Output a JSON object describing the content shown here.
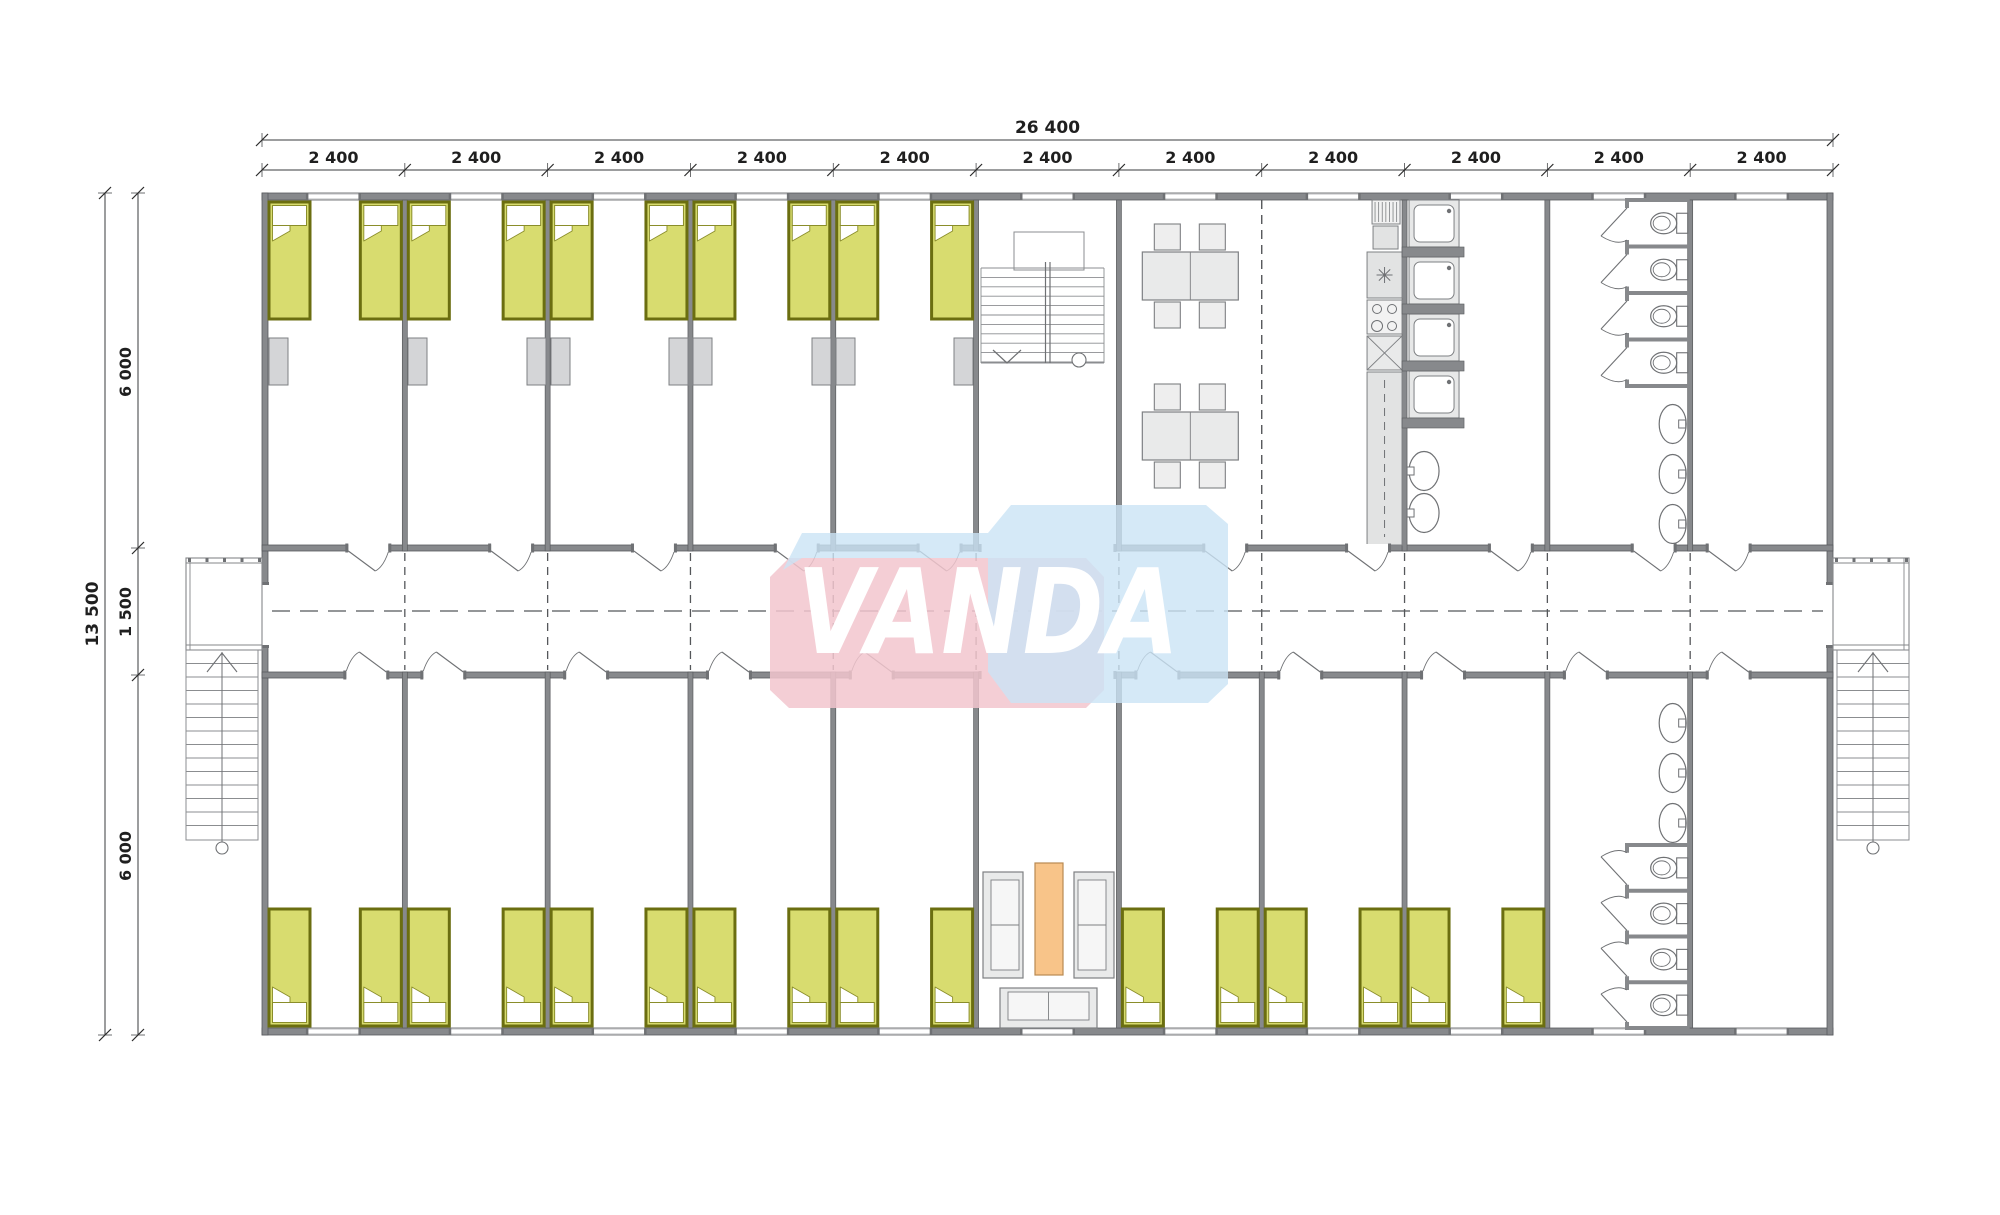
{
  "plan": {
    "type": "modular-building-floor-plan",
    "watermark": {
      "text": "VANDA",
      "pink": "#f2c6ce",
      "blue": "#cbe3f5",
      "text_color": "#ffffff"
    },
    "dimensions": {
      "total_width_label": "26 400",
      "module_labels": [
        "2 400",
        "2 400",
        "2 400",
        "2 400",
        "2 400",
        "2 400",
        "2 400",
        "2 400",
        "2 400",
        "2 400",
        "2 400"
      ],
      "total_depth_label": "13 500",
      "depth_segment_labels": [
        "6 000",
        "1 500",
        "6 000"
      ]
    },
    "rooms": {
      "top_row": [
        {
          "type": "bedroom",
          "count": 5,
          "beds_each": 2,
          "wardrobes": true,
          "window": true
        },
        {
          "type": "stairwell",
          "stair_direction": "down",
          "window": true
        },
        {
          "type": "dining",
          "tables": 2,
          "chairs_per_table": 4,
          "window": true
        },
        {
          "type": "kitchen",
          "items": [
            "drying-rack",
            "sink",
            "worktop",
            "hob-4-burners",
            "prep-unit",
            "counter"
          ],
          "window": true
        },
        {
          "type": "showers",
          "cabins": 4,
          "basins": 2,
          "window": true
        },
        {
          "type": "toilets",
          "stalls": 4,
          "basins": 3,
          "window": true
        },
        {
          "type": "room",
          "window": true
        }
      ],
      "bottom_row": [
        {
          "type": "bedroom",
          "count": 5,
          "beds_each": 2,
          "window": true
        },
        {
          "type": "lounge",
          "sofas": 3,
          "coffee_tables": 1,
          "open_to_corridor": true,
          "window": true
        },
        {
          "type": "bedroom",
          "count": 3,
          "beds_each": 2,
          "window": true
        },
        {
          "type": "toilets",
          "stalls": 4,
          "basins": 3,
          "window": true
        },
        {
          "type": "room",
          "window": true
        }
      ],
      "corridor": {
        "entrances": 2,
        "external_stairs": 2,
        "porches": 2
      }
    },
    "colors": {
      "wall": "#87898c",
      "wall_dark": "#6f7174",
      "line": "#595b5e",
      "dash": "#55575a",
      "bed_fill": "#d8dc6f",
      "bed_border": "#6b6e10",
      "pillow_border": "#8a8d2a",
      "furniture_fill": "#e9eaea",
      "furniture_stroke": "#7e8083",
      "wardrobe_fill": "#d4d5d7",
      "coffee_table_fill": "#f8c489",
      "coffee_table_stroke": "#b98a52",
      "dim_text": "#1f1f1f"
    }
  }
}
